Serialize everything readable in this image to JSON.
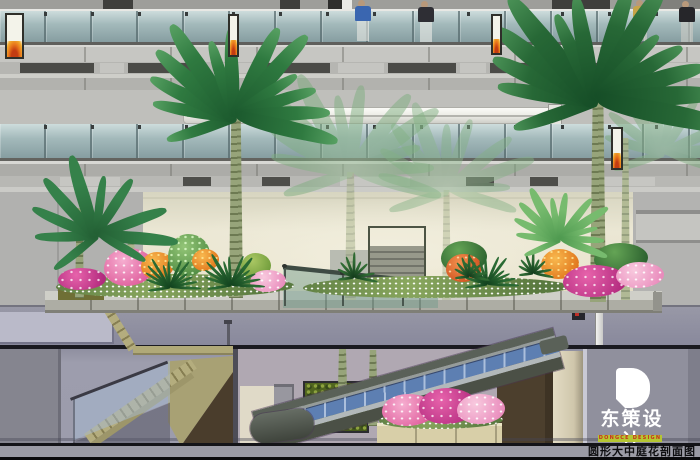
{
  "title_bar": {
    "text": "圆形大中庭花剖面图",
    "bg": "#9b9ba5",
    "text_color": "#0d0d0f"
  },
  "logo": {
    "mark": "D",
    "name": "东策设计",
    "subtitle": "DONGCE DESIGN",
    "green": "#b5c632",
    "red": "#c9301e"
  },
  "palette": {
    "glass_balustrade": "#a9bdbc",
    "wall_light": "#c6c6c2",
    "fascia_dark_panel": "#4b4b47",
    "atrium_wall_beige": "#ece8d6",
    "ground_slab": "#90909e",
    "basement_wall": "#9c9cac",
    "stair_olive": "#a9a276",
    "escalator_body": "#5a6158",
    "escalator_glass": "#5d7fb2",
    "planter_concrete": "#adada4",
    "canopy_green": "#1e5c30",
    "flower_pink": "#e86aa8",
    "flower_magenta": "#b22a7e",
    "flower_orange": "#ef8d1e",
    "greenwall": "#51661f"
  },
  "scene": {
    "banners": [
      {
        "x": 5,
        "y": 13,
        "w": 19,
        "h": 46
      },
      {
        "x": 228,
        "y": 14,
        "w": 11,
        "h": 43
      },
      {
        "x": 491,
        "y": 14,
        "w": 11,
        "h": 41
      },
      {
        "x": 611,
        "y": 127,
        "w": 12,
        "h": 43
      }
    ],
    "people": [
      {
        "x": 349,
        "y": 0,
        "shirt": "#3a66b0",
        "legs": "#e9e9e5"
      },
      {
        "x": 412,
        "y": 1,
        "shirt": "#2e2e34",
        "legs": "#edece8"
      },
      {
        "x": 627,
        "y": 0,
        "shirt": "#c8a448",
        "legs": "#d8d4cc"
      },
      {
        "x": 673,
        "y": 1,
        "shirt": "#26262a",
        "legs": "#cfcdc6"
      }
    ],
    "flora": [
      {
        "type": "trunk",
        "x": 345,
        "y": 172,
        "w": 11,
        "h": 128,
        "opacity": 0.5,
        "light": true
      },
      {
        "type": "trunk",
        "x": 442,
        "y": 190,
        "w": 9,
        "h": 110,
        "opacity": 0.45,
        "light": true
      },
      {
        "type": "palm",
        "cx": 352,
        "cy": 165,
        "len": 100,
        "n": 12,
        "colors": [
          "#9fc49d",
          "#7fae80"
        ],
        "opacity": 0.5
      },
      {
        "type": "palm",
        "cx": 448,
        "cy": 185,
        "len": 86,
        "n": 11,
        "colors": [
          "#a4c8a0",
          "#83b184"
        ],
        "opacity": 0.45
      },
      {
        "type": "palm",
        "cx": 664,
        "cy": 148,
        "len": 74,
        "n": 10,
        "colors": [
          "#9cc198",
          "#7aa97b"
        ],
        "opacity": 0.5
      },
      {
        "type": "trunk",
        "x": 229,
        "y": 96,
        "w": 14,
        "h": 202
      },
      {
        "type": "trunk",
        "x": 590,
        "y": 82,
        "w": 16,
        "h": 220
      },
      {
        "type": "trunk",
        "x": 621,
        "y": 138,
        "w": 9,
        "h": 162,
        "light": true,
        "opacity": 0.85
      },
      {
        "type": "trunk",
        "x": 75,
        "y": 208,
        "w": 9,
        "h": 90
      },
      {
        "type": "trunk",
        "x": 126,
        "y": 238,
        "w": 10,
        "h": 60,
        "light": true
      },
      {
        "type": "palm",
        "cx": 236,
        "cy": 110,
        "len": 102,
        "n": 13,
        "colors": [
          "#1c5a2e",
          "#2f7a40",
          "#57a062"
        ]
      },
      {
        "type": "palm",
        "cx": 597,
        "cy": 92,
        "len": 122,
        "n": 14,
        "colors": [
          "#164e27",
          "#276836",
          "#4a9156"
        ]
      },
      {
        "type": "blob",
        "kind": "bed",
        "x": 56,
        "y": 274,
        "w": 238,
        "h": 24
      },
      {
        "type": "blob",
        "kind": "bed",
        "x": 303,
        "y": 276,
        "w": 268,
        "h": 22
      },
      {
        "type": "blob",
        "kind": "magenta",
        "x": 58,
        "y": 268,
        "w": 48,
        "h": 22
      },
      {
        "type": "blob",
        "kind": "pink",
        "x": 104,
        "y": 248,
        "w": 50,
        "h": 38
      },
      {
        "type": "blob",
        "kind": "orange",
        "x": 141,
        "y": 252,
        "w": 33,
        "h": 27
      },
      {
        "type": "blob",
        "kind": "bushlight",
        "x": 168,
        "y": 234,
        "w": 42,
        "h": 42
      },
      {
        "type": "blob",
        "kind": "orange",
        "x": 192,
        "y": 249,
        "w": 27,
        "h": 22
      },
      {
        "type": "blob",
        "kind": "bushyellow",
        "x": 241,
        "y": 253,
        "w": 30,
        "h": 26
      },
      {
        "type": "blob",
        "kind": "pinklight",
        "x": 250,
        "y": 270,
        "w": 36,
        "h": 22
      },
      {
        "type": "blob",
        "kind": "bush",
        "x": 441,
        "y": 241,
        "w": 46,
        "h": 32
      },
      {
        "type": "blob",
        "kind": "orangered",
        "x": 446,
        "y": 254,
        "w": 36,
        "h": 28
      },
      {
        "type": "blob",
        "kind": "orange",
        "x": 541,
        "y": 249,
        "w": 38,
        "h": 30
      },
      {
        "type": "blob",
        "kind": "bush",
        "x": 594,
        "y": 243,
        "w": 54,
        "h": 30
      },
      {
        "type": "blob",
        "kind": "magenta",
        "x": 563,
        "y": 265,
        "w": 64,
        "h": 32
      },
      {
        "type": "blob",
        "kind": "pinklight",
        "x": 616,
        "y": 262,
        "w": 48,
        "h": 26
      },
      {
        "type": "cycad",
        "cx": 170,
        "cy": 286,
        "len": 30,
        "n": 13,
        "colors": [
          "#12421e",
          "#2a6a33"
        ]
      },
      {
        "type": "cycad",
        "cx": 231,
        "cy": 284,
        "len": 33,
        "n": 13,
        "colors": [
          "#12421e",
          "#2a6a33"
        ]
      },
      {
        "type": "cycad",
        "cx": 487,
        "cy": 283,
        "len": 31,
        "n": 13,
        "colors": [
          "#12421e",
          "#2a6a33"
        ]
      },
      {
        "type": "grass",
        "cx": 354,
        "cy": 276,
        "len": 22,
        "n": 9,
        "colors": [
          "#143c1c",
          "#2f6a33"
        ]
      },
      {
        "type": "grass",
        "cx": 469,
        "cy": 275,
        "len": 20,
        "n": 9,
        "colors": [
          "#143c1c",
          "#2f6a33"
        ]
      },
      {
        "type": "grass",
        "cx": 533,
        "cy": 272,
        "len": 20,
        "n": 9,
        "colors": [
          "#143c1c",
          "#2f6a33"
        ]
      },
      {
        "type": "palm",
        "cx": 97,
        "cy": 230,
        "len": 76,
        "n": 10,
        "colors": [
          "#236034",
          "#35814a"
        ],
        "a0": -215,
        "a1": 25
      },
      {
        "type": "palm",
        "cx": 560,
        "cy": 236,
        "len": 54,
        "n": 12,
        "colors": [
          "#4f9a50",
          "#77bb6e"
        ],
        "a0": -200,
        "a1": 20
      },
      {
        "type": "blob",
        "kind": "bed",
        "x": 379,
        "y": 411,
        "w": 124,
        "h": 18
      },
      {
        "type": "blob",
        "kind": "pink",
        "x": 382,
        "y": 394,
        "w": 54,
        "h": 32
      },
      {
        "type": "blob",
        "kind": "magenta",
        "x": 419,
        "y": 388,
        "w": 58,
        "h": 36
      },
      {
        "type": "blob",
        "kind": "pinklight",
        "x": 457,
        "y": 394,
        "w": 48,
        "h": 30
      }
    ]
  }
}
